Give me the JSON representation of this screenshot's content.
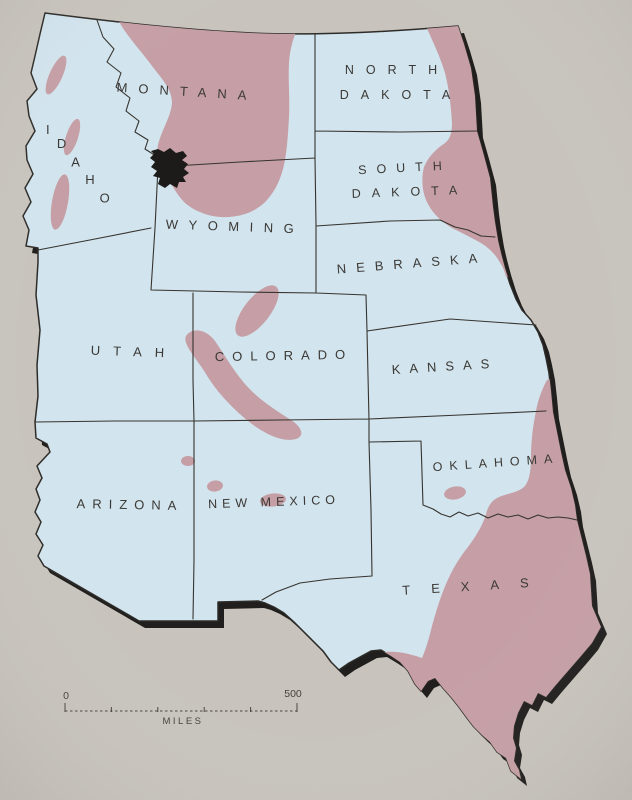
{
  "map": {
    "states": {
      "montana": "MONTANA",
      "north_dakota": [
        "NORTH",
        "DAKOTA"
      ],
      "idaho": "IDAHO",
      "wyoming": "WYOMING",
      "south_dakota": [
        "SOUTH",
        "DAKOTA"
      ],
      "nebraska": "NEBRASKA",
      "utah": "UTAH",
      "colorado": "COLORADO",
      "kansas": "KANSAS",
      "arizona": "ARIZONA",
      "new_mexico": "NEW MEXICO",
      "oklahoma": "OKLAHOMA",
      "texas": "TEXAS"
    },
    "scale_bar": {
      "start_label": "0",
      "end_label": "500",
      "unit_label": "MILES"
    },
    "colors": {
      "background": "#c8c4bd",
      "land": "#d2e4ee",
      "shaded_region": "#c59fa5",
      "marker": "#1c1b19",
      "outline": "#2e2c29",
      "border_line": "#36342f",
      "shadow": "#201f1d",
      "label_text": "#3b3935"
    }
  }
}
